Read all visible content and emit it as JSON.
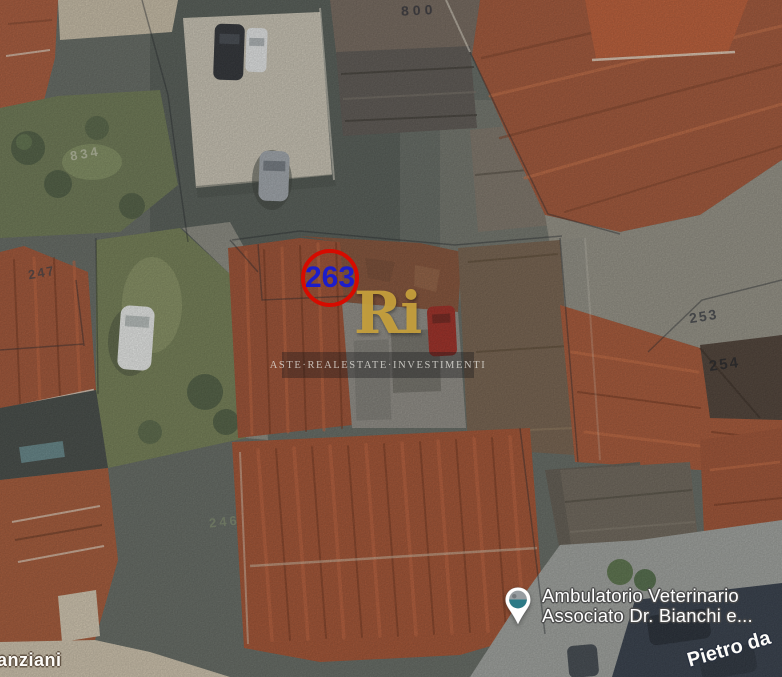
{
  "map": {
    "marker": {
      "number": "263",
      "circle_color": "#d60b00",
      "number_color": "#1d1dca"
    },
    "watermark": {
      "logo_text": "Ri",
      "logo_color": "#c9a23c",
      "caption": "ASTE·REALESTATE·INVESTIMENTI"
    },
    "parcel_labels": [
      {
        "text": "800"
      },
      {
        "text": "834"
      },
      {
        "text": "247"
      },
      {
        "text": "253"
      },
      {
        "text": "254"
      },
      {
        "text": "246"
      }
    ],
    "street_labels": [
      {
        "text": "anziani"
      },
      {
        "text": "Pietro da"
      }
    ],
    "poi": {
      "icon": "map-pin-photo",
      "name_line1": "Ambulatorio Veterinario",
      "name_line2": "Associato Dr. Bianchi e...",
      "pin_colors": {
        "body": "#ffffff",
        "photo_top": "#979da1",
        "photo_bottom": "#2d7a86"
      }
    }
  }
}
